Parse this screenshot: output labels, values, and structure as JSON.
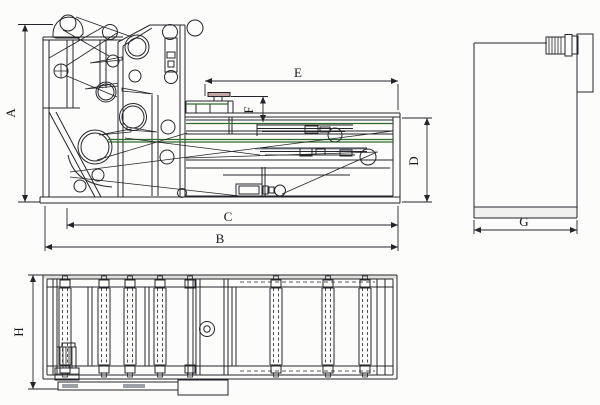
{
  "dimensions": {
    "A": "A",
    "B": "B",
    "C": "C",
    "D": "D",
    "E": "E",
    "F": "F",
    "G": "G",
    "H": "H"
  },
  "colors": {
    "line": "#26242a",
    "belt_green": "#2f6b2f",
    "steel_blue": "#8796a8",
    "fill_grey": "#9aa0a6",
    "cap_pink": "#c4a6a6",
    "paper": "#fcfcfa",
    "plan_top_band": "#dde2da"
  }
}
